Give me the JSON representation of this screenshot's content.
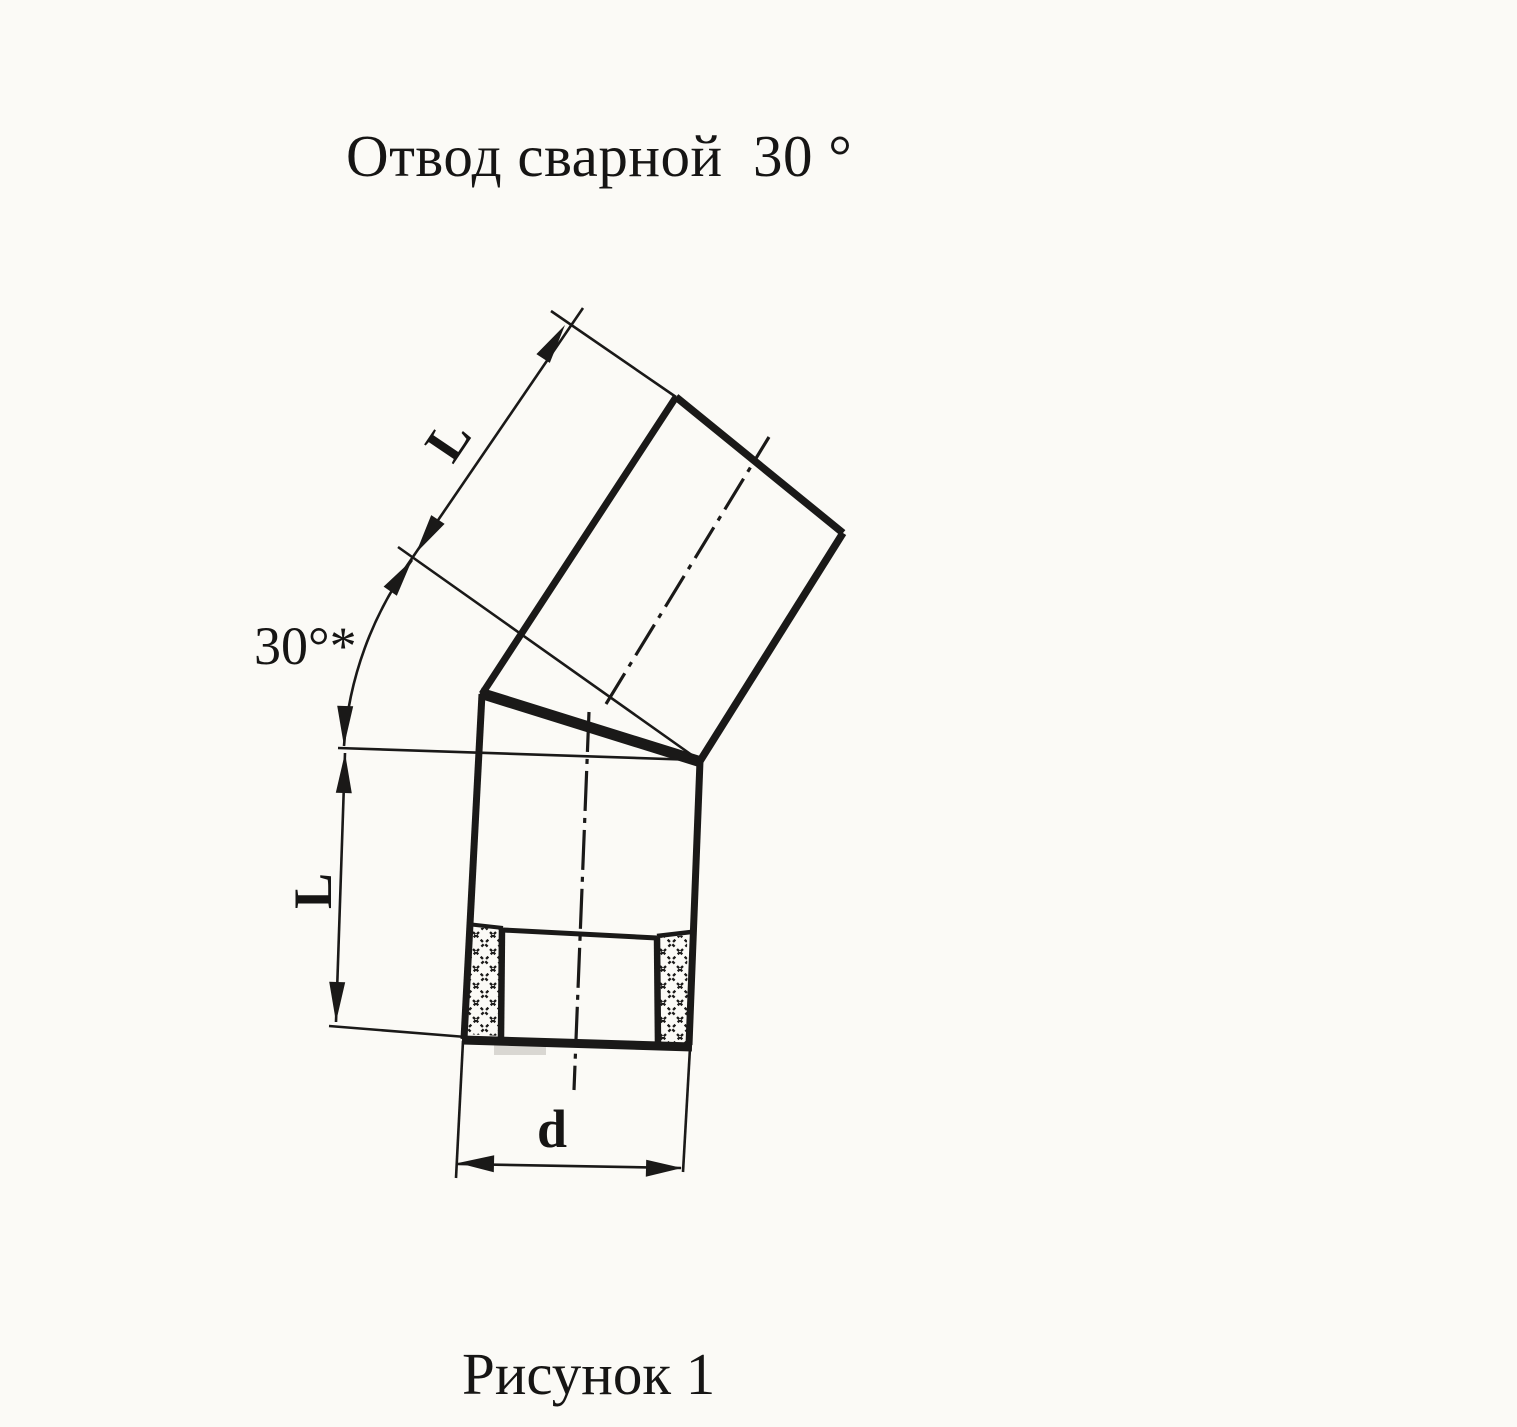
{
  "colors": {
    "paper": "#fbfaf6",
    "ink": "#1a1918"
  },
  "title": {
    "text": "Отвод сварной  30 °"
  },
  "figure": {
    "caption": "Рисунок 1",
    "subject": "welded-pipe-elbow-30-degree-technical-drawing",
    "labels": {
      "angle": "30°*",
      "segment_length_upper": "L",
      "segment_length_lower": "L",
      "diameter": "d"
    }
  }
}
